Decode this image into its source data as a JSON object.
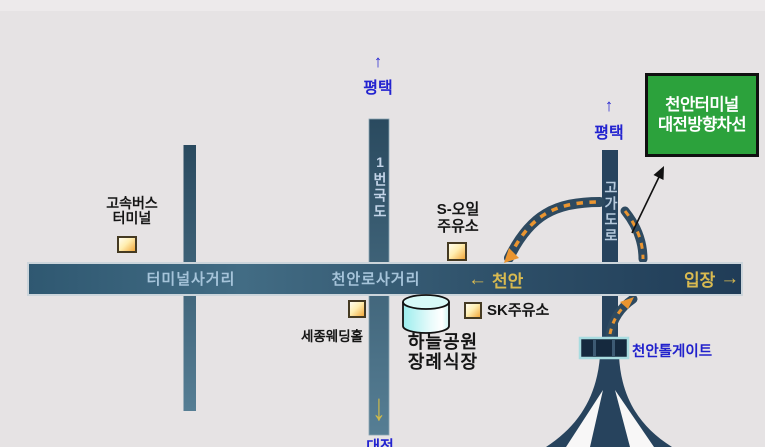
{
  "title": "천안 하늘공원 장례식장 약도",
  "directions": {
    "pyeongtaek_top": {
      "label": "평택"
    },
    "pyeongtaek_right": {
      "label": "평택"
    },
    "daejeon_bottom": {
      "label": "대전"
    },
    "cheonan_left": {
      "label": "천안"
    },
    "ipjang_right": {
      "label": "입장"
    }
  },
  "icons": {
    "arrow_up": "↑",
    "arrow_down": "↓",
    "arrow_left": "←",
    "arrow_right": "→"
  },
  "roads": {
    "route1_label": "1번국도",
    "overpass_label": "고가도로",
    "terminal_intersection_label": "터미널사거리",
    "cheonanro_intersection_label": "천안로사거리"
  },
  "landmarks": {
    "express_bus_terminal": {
      "line1": "고속버스",
      "line2": "터미널"
    },
    "s_oil_station": {
      "line1": "S-오일",
      "line2": "주유소"
    },
    "sejong_wedding_hall": {
      "label": "세종웨딩홀"
    },
    "sk_station": {
      "label": "SK주유소"
    },
    "sky_park_funeral": {
      "line1": "하늘공원",
      "line2": "장례식장"
    },
    "tollgate": {
      "label": "천안톨게이트"
    }
  },
  "sign": {
    "line1": "천안터미널",
    "line2": "대전방향차선"
  },
  "colors": {
    "background": "#e6e3e4",
    "road_steel": "#3d657c",
    "highway_navy": "#27435d",
    "dash_orange": "#ea9530",
    "road_label_text": "#a6c4da",
    "gold_text": "#d9ba50",
    "blue_label": "#2323d0",
    "tollgate_blue": "#2121cc",
    "sign_green": "#2ca23c",
    "box_yellow": "#f2a83c",
    "cylinder_cyan": "#9beded"
  }
}
